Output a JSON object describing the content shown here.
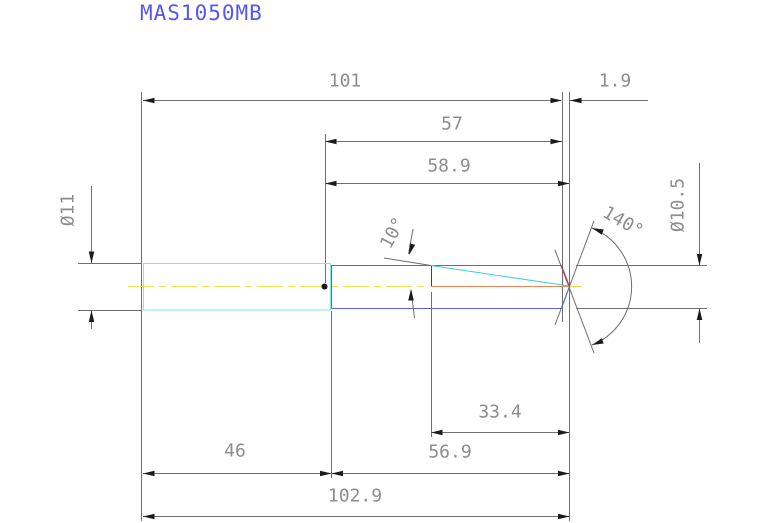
{
  "drawing": {
    "title": "MAS1050MB",
    "dimensions": {
      "body_plus_shank_length": "101",
      "point_length": "1.9",
      "flute_length": "57",
      "flute_length_to_point": "58.9",
      "shank_diameter": "Ø11",
      "cut_diameter": "Ø10.5",
      "taper_angle": "10°",
      "point_angle": "140°",
      "tip_section_length": "33.4",
      "shank_length": "46",
      "body_length": "56.9",
      "overall_length": "102.9"
    },
    "colors": {
      "title_text": "#5757ee",
      "dimension_text": "#8d8d8d",
      "dimension_lines": "#6f6f6f",
      "arrowheads": "#1b1b1b",
      "shank_outline": "#7ce8ea",
      "body_outline": "#5b63d6",
      "point_edge_upper": "#c8244c",
      "point_edge_lower": "#4f6ce0",
      "internal_feature_line": "#8c2342",
      "hole_centerline": "#ee8558",
      "taper_line": "#3bd2d8",
      "centerline": "#e8e84e"
    }
  }
}
